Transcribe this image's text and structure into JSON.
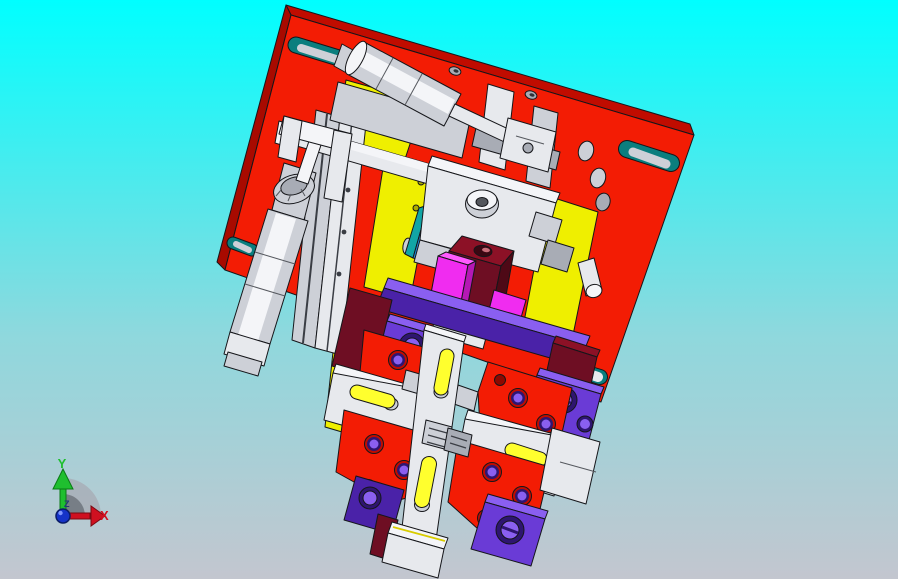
{
  "viewport": {
    "background_top": "#00FFFF",
    "background_mid": "#8FD8DD",
    "background_bottom": "#C3C6CF",
    "render_style": "shaded-with-edges"
  },
  "triad": {
    "x_label": "X",
    "y_label": "Y",
    "z_label": "Z",
    "x_color": "#CF1020",
    "y_color": "#1FBF2F",
    "z_color": "#233877",
    "origin_color": "#1533C8"
  },
  "model": {
    "name": "machining-fixture-assembly",
    "parts": [
      {
        "name": "base-plate",
        "color": "#F31C04"
      },
      {
        "name": "backing-plates",
        "color": "#EFEF00"
      },
      {
        "name": "horizontal-air-cylinder",
        "color": "#E7E9ED"
      },
      {
        "name": "vertical-air-cylinder",
        "color": "#E7E9ED"
      },
      {
        "name": "clamp-arm",
        "color": "#F4F5F8"
      },
      {
        "name": "center-bracket",
        "color": "#E7E9ED"
      },
      {
        "name": "slide-plate",
        "color": "#1E8FE0"
      },
      {
        "name": "locator-blocks",
        "color": "#6E0E23"
      },
      {
        "name": "wear-pads",
        "color": "#F02CF0"
      },
      {
        "name": "rail-clamp-blocks",
        "color": "#6A3BD6"
      },
      {
        "name": "clamp-plates",
        "color": "#F31C04"
      },
      {
        "name": "slide-arms",
        "color": "#E7E9ED"
      },
      {
        "name": "center-slide-bar",
        "color": "#E7E9ED"
      },
      {
        "name": "foot-block",
        "color": "#E7E9ED"
      }
    ]
  },
  "palette": {
    "bg_top": "#00FFFF",
    "bg_mid": "#8FD8DD",
    "bg_bottom": "#C3C6CF",
    "red_face": "#F31C04",
    "red_bright": "#FF3D1F",
    "red_dark": "#C00C00",
    "red_side": "#A80A00",
    "yellow_face": "#EFEF00",
    "yellow_hi": "#FFFF2E",
    "yellow_dark": "#ABAB00",
    "white_hi": "#F4F5F8",
    "white_face": "#E7E9ED",
    "white_mid": "#CDD0D7",
    "white_dark": "#A8ACB5",
    "purple_face": "#6A3BD6",
    "purple_hi": "#8A5FF0",
    "purple_dark": "#4A22A8",
    "purple_deep": "#2E1570",
    "magenta_face": "#F02CF0",
    "magenta_hi": "#FF5AFF",
    "magenta_dark": "#B518B5",
    "maroon_face": "#6E0E23",
    "maroon_hi": "#8C1126",
    "maroon_dark": "#4E0916",
    "blue_face": "#1E8FE0",
    "blue_hi": "#3AA6F2",
    "blue_dark": "#0E6FA8",
    "teal_slot": "#0B7E7E",
    "teal_sliver": "#12A5A5",
    "edge": "#15161A",
    "axis_x": "#CF1020",
    "axis_y": "#1FBF2F",
    "axis_z": "#233877",
    "origin_blue": "#1533C8",
    "fan_light": "#A7ADB5",
    "fan_dark": "#6E747C"
  }
}
